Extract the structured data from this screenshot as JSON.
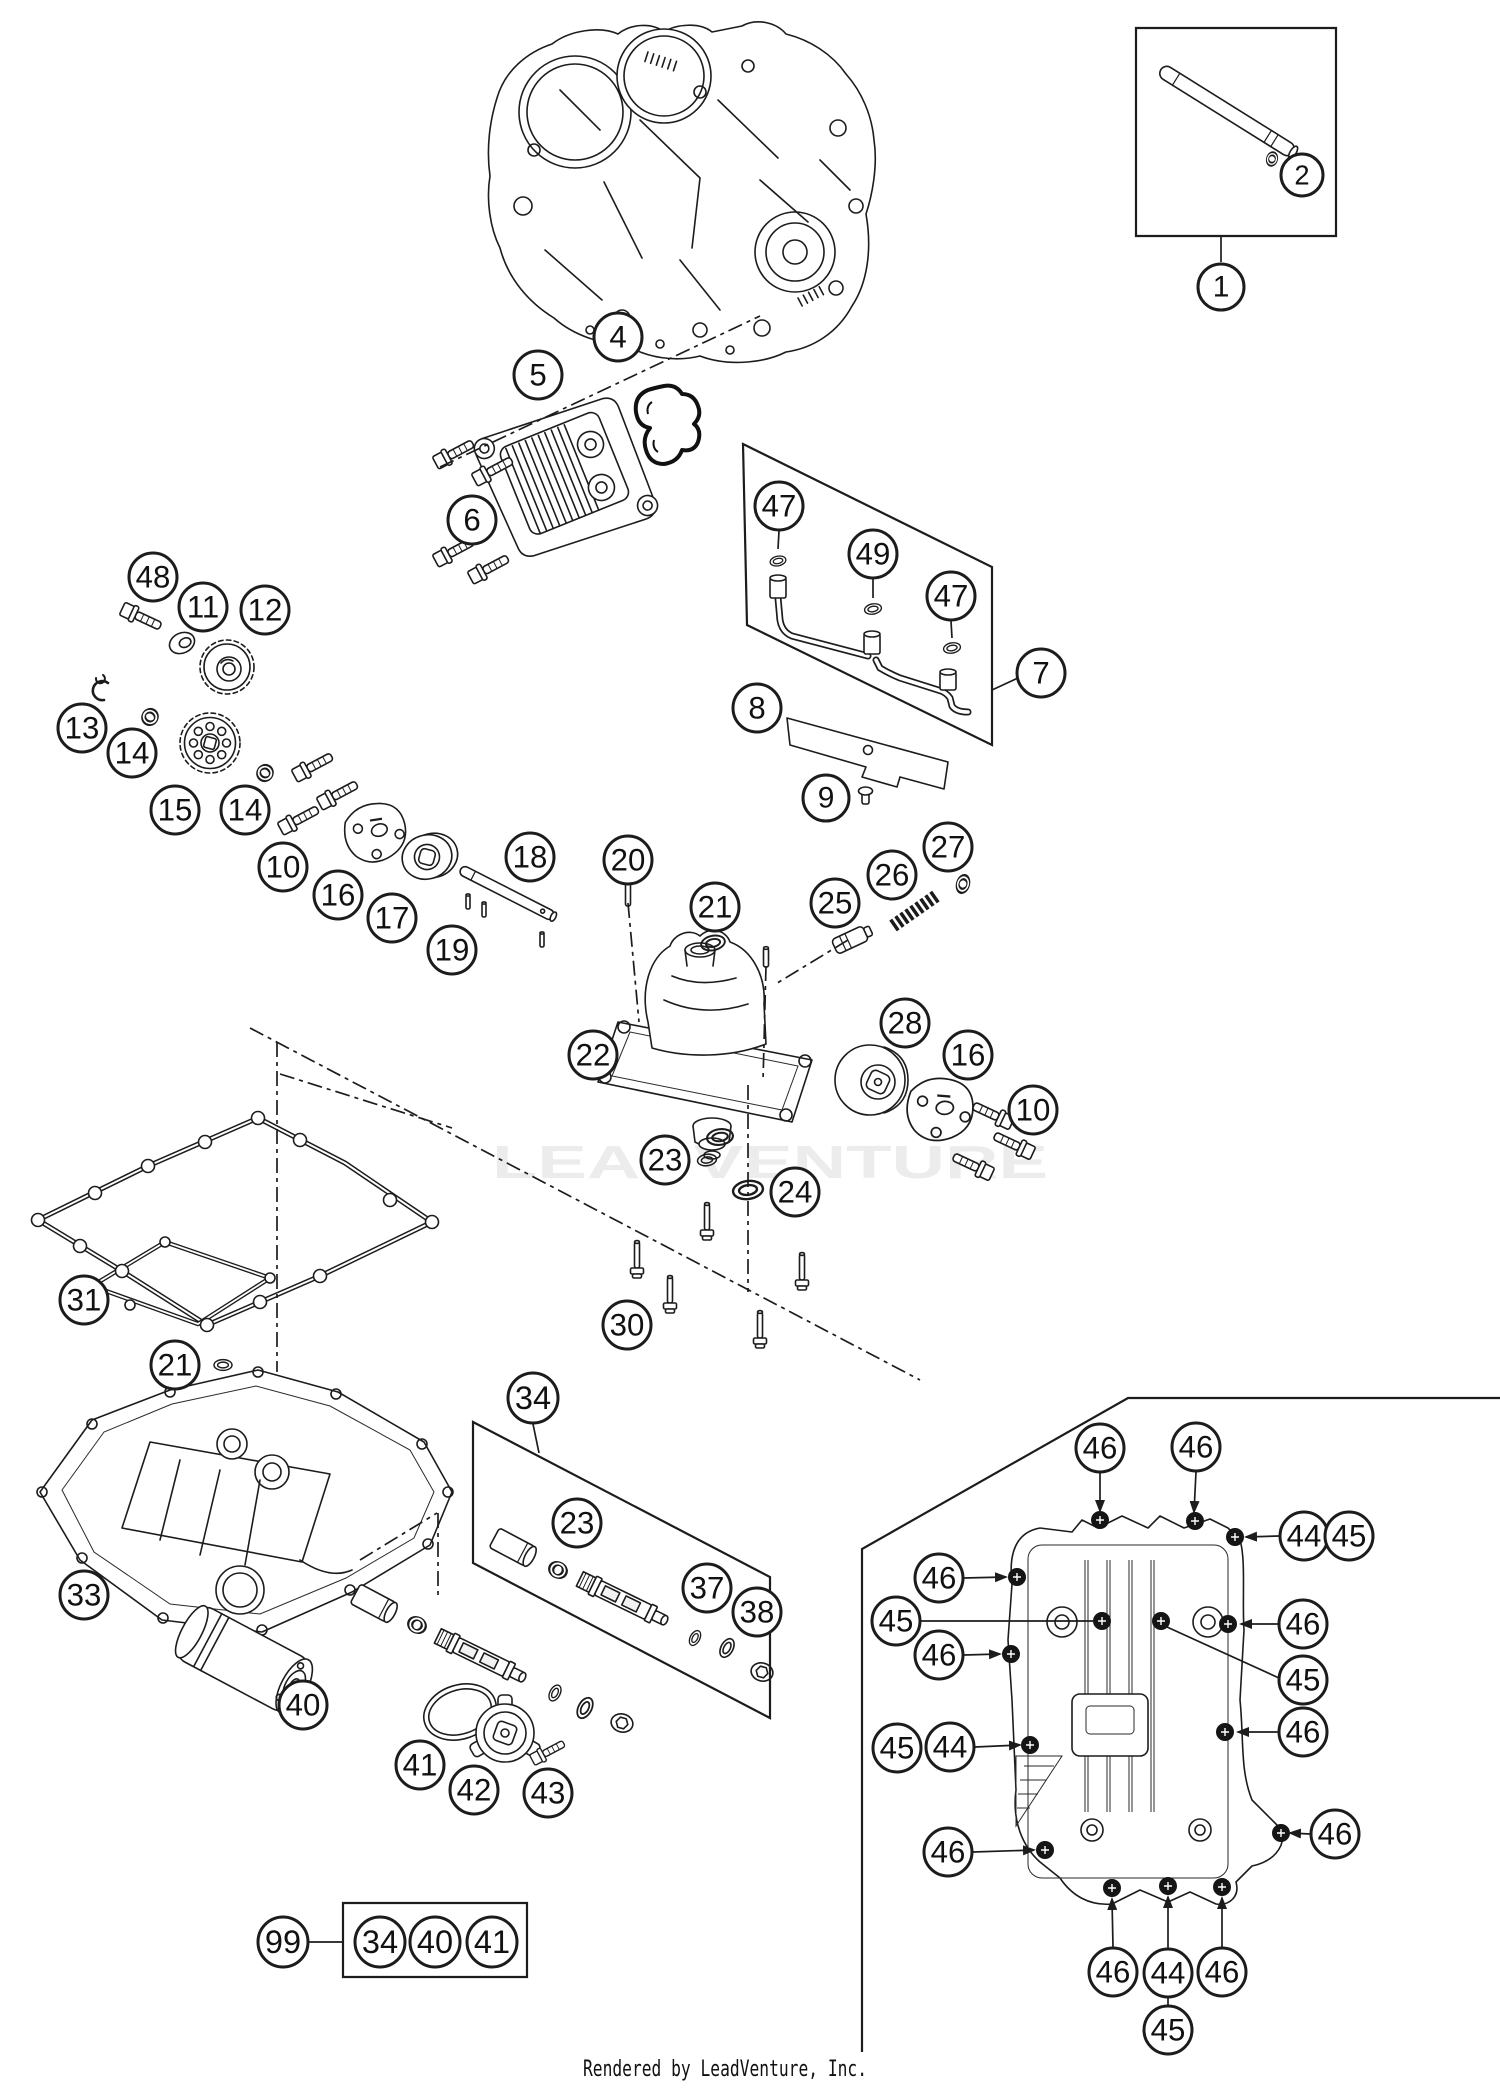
{
  "page": {
    "width": 1500,
    "height": 2088,
    "background": "#ffffff",
    "ink_color": "#1c1c1c"
  },
  "watermark": {
    "text": "LEADVENTURE",
    "color": "#ececec",
    "x": 492,
    "y": 1178,
    "font_size": 46,
    "text_length": 556
  },
  "footer": {
    "text": "Rendered by LeadVenture, Inc.",
    "color": "#111111",
    "x": 583,
    "y": 2076,
    "font_size": 22,
    "text_length": 284
  },
  "callouts": [
    {
      "label": "1",
      "x": 1221,
      "y": 287,
      "r": 23
    },
    {
      "label": "2",
      "x": 1302,
      "y": 175,
      "r": 21
    },
    {
      "label": "4",
      "x": 618,
      "y": 337,
      "r": 24
    },
    {
      "label": "5",
      "x": 538,
      "y": 375,
      "r": 24
    },
    {
      "label": "6",
      "x": 472,
      "y": 520,
      "r": 24
    },
    {
      "label": "47",
      "x": 779,
      "y": 506,
      "r": 24
    },
    {
      "label": "49",
      "x": 873,
      "y": 554,
      "r": 24
    },
    {
      "label": "47",
      "x": 951,
      "y": 596,
      "r": 24
    },
    {
      "label": "7",
      "x": 1041,
      "y": 673,
      "r": 24
    },
    {
      "label": "8",
      "x": 757,
      "y": 708,
      "r": 24
    },
    {
      "label": "9",
      "x": 826,
      "y": 798,
      "r": 23
    },
    {
      "label": "48",
      "x": 153,
      "y": 577,
      "r": 24
    },
    {
      "label": "11",
      "x": 203,
      "y": 607,
      "r": 24
    },
    {
      "label": "12",
      "x": 265,
      "y": 610,
      "r": 24
    },
    {
      "label": "13",
      "x": 82,
      "y": 728,
      "r": 24
    },
    {
      "label": "14",
      "x": 132,
      "y": 753,
      "r": 24
    },
    {
      "label": "15",
      "x": 175,
      "y": 810,
      "r": 24
    },
    {
      "label": "14",
      "x": 245,
      "y": 810,
      "r": 24
    },
    {
      "label": "10",
      "x": 283,
      "y": 867,
      "r": 24
    },
    {
      "label": "16",
      "x": 338,
      "y": 895,
      "r": 24
    },
    {
      "label": "17",
      "x": 392,
      "y": 918,
      "r": 24
    },
    {
      "label": "18",
      "x": 530,
      "y": 857,
      "r": 24
    },
    {
      "label": "19",
      "x": 452,
      "y": 950,
      "r": 24
    },
    {
      "label": "20",
      "x": 628,
      "y": 860,
      "r": 24
    },
    {
      "label": "21",
      "x": 715,
      "y": 907,
      "r": 24
    },
    {
      "label": "25",
      "x": 835,
      "y": 903,
      "r": 24
    },
    {
      "label": "26",
      "x": 892,
      "y": 875,
      "r": 24
    },
    {
      "label": "27",
      "x": 948,
      "y": 847,
      "r": 24
    },
    {
      "label": "22",
      "x": 593,
      "y": 1055,
      "r": 24
    },
    {
      "label": "28",
      "x": 905,
      "y": 1023,
      "r": 24
    },
    {
      "label": "16",
      "x": 968,
      "y": 1055,
      "r": 24
    },
    {
      "label": "10",
      "x": 1033,
      "y": 1110,
      "r": 24
    },
    {
      "label": "23",
      "x": 665,
      "y": 1160,
      "r": 24
    },
    {
      "label": "24",
      "x": 795,
      "y": 1192,
      "r": 24
    },
    {
      "label": "30",
      "x": 627,
      "y": 1325,
      "r": 24
    },
    {
      "label": "31",
      "x": 84,
      "y": 1300,
      "r": 24
    },
    {
      "label": "21",
      "x": 175,
      "y": 1365,
      "r": 24
    },
    {
      "label": "33",
      "x": 84,
      "y": 1595,
      "r": 24
    },
    {
      "label": "34",
      "x": 533,
      "y": 1398,
      "r": 25
    },
    {
      "label": "23",
      "x": 577,
      "y": 1523,
      "r": 24
    },
    {
      "label": "37",
      "x": 707,
      "y": 1588,
      "r": 24
    },
    {
      "label": "38",
      "x": 757,
      "y": 1612,
      "r": 24
    },
    {
      "label": "40",
      "x": 303,
      "y": 1705,
      "r": 24
    },
    {
      "label": "41",
      "x": 420,
      "y": 1765,
      "r": 24
    },
    {
      "label": "42",
      "x": 474,
      "y": 1790,
      "r": 24
    },
    {
      "label": "43",
      "x": 548,
      "y": 1793,
      "r": 24
    },
    {
      "label": "99",
      "x": 283,
      "y": 1942,
      "r": 25
    },
    {
      "label": "34",
      "x": 380,
      "y": 1942,
      "r": 25
    },
    {
      "label": "40",
      "x": 435,
      "y": 1942,
      "r": 25
    },
    {
      "label": "41",
      "x": 492,
      "y": 1942,
      "r": 25
    },
    {
      "label": "46",
      "x": 1100,
      "y": 1448,
      "r": 24
    },
    {
      "label": "46",
      "x": 1196,
      "y": 1447,
      "r": 24
    },
    {
      "label": "44",
      "x": 1304,
      "y": 1536,
      "r": 24
    },
    {
      "label": "45",
      "x": 1349,
      "y": 1536,
      "r": 24
    },
    {
      "label": "46",
      "x": 939,
      "y": 1578,
      "r": 24
    },
    {
      "label": "45",
      "x": 896,
      "y": 1621,
      "r": 24
    },
    {
      "label": "46",
      "x": 939,
      "y": 1655,
      "r": 24
    },
    {
      "label": "46",
      "x": 1303,
      "y": 1624,
      "r": 24
    },
    {
      "label": "45",
      "x": 1303,
      "y": 1680,
      "r": 24
    },
    {
      "label": "46",
      "x": 1303,
      "y": 1732,
      "r": 24
    },
    {
      "label": "45",
      "x": 897,
      "y": 1748,
      "r": 24
    },
    {
      "label": "44",
      "x": 950,
      "y": 1747,
      "r": 24
    },
    {
      "label": "46",
      "x": 948,
      "y": 1852,
      "r": 24
    },
    {
      "label": "46",
      "x": 1335,
      "y": 1834,
      "r": 24
    },
    {
      "label": "46",
      "x": 1113,
      "y": 1972,
      "r": 24
    },
    {
      "label": "44",
      "x": 1168,
      "y": 1973,
      "r": 24
    },
    {
      "label": "46",
      "x": 1222,
      "y": 1972,
      "r": 24
    },
    {
      "label": "45",
      "x": 1168,
      "y": 2030,
      "r": 24
    }
  ],
  "leaders": [
    {
      "x1": 1221,
      "y1": 236,
      "x2": 1221,
      "y2": 262,
      "arrow": false,
      "style": "solid"
    },
    {
      "x1": 309,
      "y1": 1942,
      "x2": 343,
      "y2": 1942,
      "arrow": false,
      "style": "solid"
    },
    {
      "x1": 533,
      "y1": 1424,
      "x2": 539,
      "y2": 1453,
      "arrow": false,
      "style": "solid"
    },
    {
      "x1": 1018,
      "y1": 678,
      "x2": 992,
      "y2": 690,
      "arrow": false,
      "style": "solid"
    },
    {
      "x1": 779,
      "y1": 531,
      "x2": 778,
      "y2": 549,
      "arrow": false,
      "style": "solid"
    },
    {
      "x1": 873,
      "y1": 579,
      "x2": 873,
      "y2": 598,
      "arrow": false,
      "style": "solid"
    },
    {
      "x1": 951,
      "y1": 621,
      "x2": 952,
      "y2": 638,
      "arrow": false,
      "style": "solid"
    },
    {
      "x1": 1100,
      "y1": 1473,
      "x2": 1100,
      "y2": 1511,
      "arrow": true,
      "style": "solid"
    },
    {
      "x1": 1196,
      "y1": 1472,
      "x2": 1194,
      "y2": 1512,
      "arrow": true,
      "style": "solid"
    },
    {
      "x1": 1279,
      "y1": 1536,
      "x2": 1246,
      "y2": 1537,
      "arrow": true,
      "style": "solid"
    },
    {
      "x1": 964,
      "y1": 1578,
      "x2": 1006,
      "y2": 1577,
      "arrow": true,
      "style": "solid"
    },
    {
      "x1": 964,
      "y1": 1655,
      "x2": 1000,
      "y2": 1654,
      "arrow": true,
      "style": "solid"
    },
    {
      "x1": 1278,
      "y1": 1624,
      "x2": 1241,
      "y2": 1624,
      "arrow": true,
      "style": "solid"
    },
    {
      "x1": 1278,
      "y1": 1732,
      "x2": 1238,
      "y2": 1732,
      "arrow": true,
      "style": "solid"
    },
    {
      "x1": 975,
      "y1": 1747,
      "x2": 1020,
      "y2": 1745,
      "arrow": true,
      "style": "solid"
    },
    {
      "x1": 973,
      "y1": 1852,
      "x2": 1034,
      "y2": 1850,
      "arrow": true,
      "style": "solid"
    },
    {
      "x1": 1310,
      "y1": 1834,
      "x2": 1290,
      "y2": 1833,
      "arrow": true,
      "style": "solid"
    },
    {
      "x1": 1113,
      "y1": 1947,
      "x2": 1112,
      "y2": 1899,
      "arrow": true,
      "style": "solid"
    },
    {
      "x1": 1168,
      "y1": 1948,
      "x2": 1168,
      "y2": 1897,
      "arrow": true,
      "style": "solid"
    },
    {
      "x1": 1222,
      "y1": 1947,
      "x2": 1222,
      "y2": 1898,
      "arrow": true,
      "style": "solid"
    },
    {
      "x1": 920,
      "y1": 1621,
      "x2": 1094,
      "y2": 1621,
      "arrow": false,
      "style": "solid"
    },
    {
      "x1": 1279,
      "y1": 1678,
      "x2": 1167,
      "y2": 1627,
      "arrow": false,
      "style": "solid"
    },
    {
      "x1": 1168,
      "y1": 2005,
      "x2": 1168,
      "y2": 1998,
      "arrow": false,
      "style": "solid"
    },
    {
      "x1": 440,
      "y1": 467,
      "x2": 760,
      "y2": 316,
      "arrow": false,
      "style": "dashdot"
    },
    {
      "x1": 628,
      "y1": 903,
      "x2": 639,
      "y2": 1022,
      "arrow": false,
      "style": "dashdot"
    },
    {
      "x1": 766,
      "y1": 966,
      "x2": 763,
      "y2": 1082,
      "arrow": false,
      "style": "dashdot"
    },
    {
      "x1": 848,
      "y1": 940,
      "x2": 774,
      "y2": 985,
      "arrow": false,
      "style": "dashdot"
    },
    {
      "x1": 748,
      "y1": 1085,
      "x2": 748,
      "y2": 1292,
      "arrow": false,
      "style": "dashdot"
    },
    {
      "x1": 250,
      "y1": 1028,
      "x2": 920,
      "y2": 1380,
      "arrow": false,
      "style": "dashdot"
    },
    {
      "x1": 277,
      "y1": 1042,
      "x2": 277,
      "y2": 1372,
      "arrow": false,
      "style": "dashdot"
    },
    {
      "x1": 280,
      "y1": 1074,
      "x2": 452,
      "y2": 1128,
      "arrow": false,
      "style": "dashdot"
    },
    {
      "x1": 360,
      "y1": 1560,
      "x2": 437,
      "y2": 1513,
      "arrow": false,
      "style": "dashdot"
    },
    {
      "x1": 438,
      "y1": 1513,
      "x2": 438,
      "y2": 1597,
      "arrow": false,
      "style": "dashdot"
    }
  ],
  "ref_boxes": [
    {
      "name": "kit-1-box",
      "points": "1136,28 1336,28 1336,236 1136,236",
      "open": false
    },
    {
      "name": "oil-pipe-kit-7-box",
      "points": "743,444 992,567 992,745 747,625",
      "open": false
    },
    {
      "name": "bypass-kit-34-box",
      "points": "473,1422 770,1577 770,1718 473,1563",
      "open": false
    },
    {
      "name": "kit-99-box",
      "points": "343,1903 527,1903 527,1977 343,1977",
      "open": false
    },
    {
      "name": "pan-detail-border",
      "points": "1500,1398 1128,1398 862,1549 862,2052",
      "open": true
    }
  ]
}
